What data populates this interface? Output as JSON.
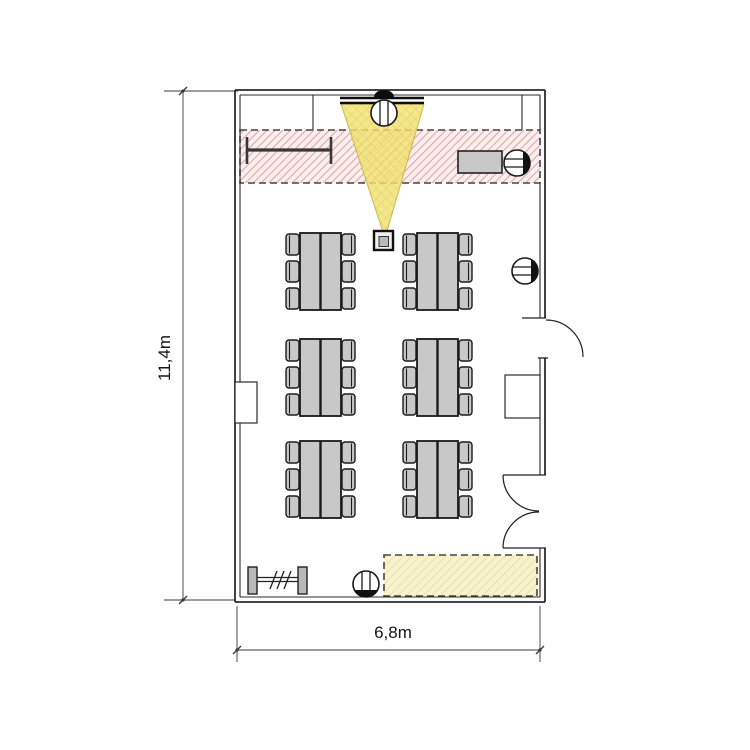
{
  "diagram": {
    "type": "floor-plan",
    "title": "Classroom floor plan, 6 table groups with projector",
    "room": {
      "height_dimension_label": "11,4m",
      "width_dimension_label": "6,8m"
    },
    "zones": {
      "teaching_zone": {
        "name": "front teaching zone",
        "style": "red diagonal hatch, dashed outline"
      },
      "projection_cone": {
        "name": "projector beam onto screen",
        "style": "yellow translucent cone"
      },
      "storage_zone": {
        "name": "rear reserved zone",
        "style": "yellow diagonal hatch, dashed outline"
      }
    },
    "fixtures": [
      {
        "name": "projection-screen",
        "location": "top wall center"
      },
      {
        "name": "ceiling-projector",
        "location": "center, end of beam cone"
      },
      {
        "name": "whiteboard",
        "location": "top left wall inside teaching zone"
      },
      {
        "name": "cabinet",
        "location": "top right inside teaching zone"
      },
      {
        "name": "wash-basin-front",
        "location": "top wall at screen"
      },
      {
        "name": "wash-basin-top-right",
        "location": "right wall in teaching zone"
      },
      {
        "name": "wash-basin-mid-right",
        "location": "right wall"
      },
      {
        "name": "wash-basin-rear",
        "location": "bottom wall center"
      },
      {
        "name": "coat-rack",
        "location": "bottom left"
      },
      {
        "name": "single-door",
        "location": "right wall upper, swings outward"
      },
      {
        "name": "double-door",
        "location": "right wall lower, swings inward"
      },
      {
        "name": "wall-recess",
        "location": "right wall between doors"
      },
      {
        "name": "pilaster",
        "location": "left wall middle"
      }
    ],
    "furniture": {
      "table_groups": {
        "rows": 3,
        "columns": 2,
        "seats_per_group": 6,
        "total_seats": 36
      }
    }
  },
  "layout": {
    "tables": {
      "columns_x": [
        300,
        417
      ],
      "rows_y": [
        233,
        339,
        441
      ],
      "width": 41,
      "height": 77,
      "chair": {
        "width": 13,
        "height": 21,
        "offsets_y": [
          1,
          28,
          55
        ]
      }
    }
  },
  "colors": {
    "furniture_fill": "#c8c8c8",
    "furniture_stroke": "#1a1a1a",
    "cone_yellow": "#f2e270",
    "zone_red_stripe": "#dc9a9a",
    "zone_red_bg": "#faeeee",
    "zone_yellow_bg": "#f8f3cf",
    "zone_yellow_stripe": "#e6d993",
    "wall": "#2b2b2b",
    "dimension": "#3a3a3a"
  }
}
